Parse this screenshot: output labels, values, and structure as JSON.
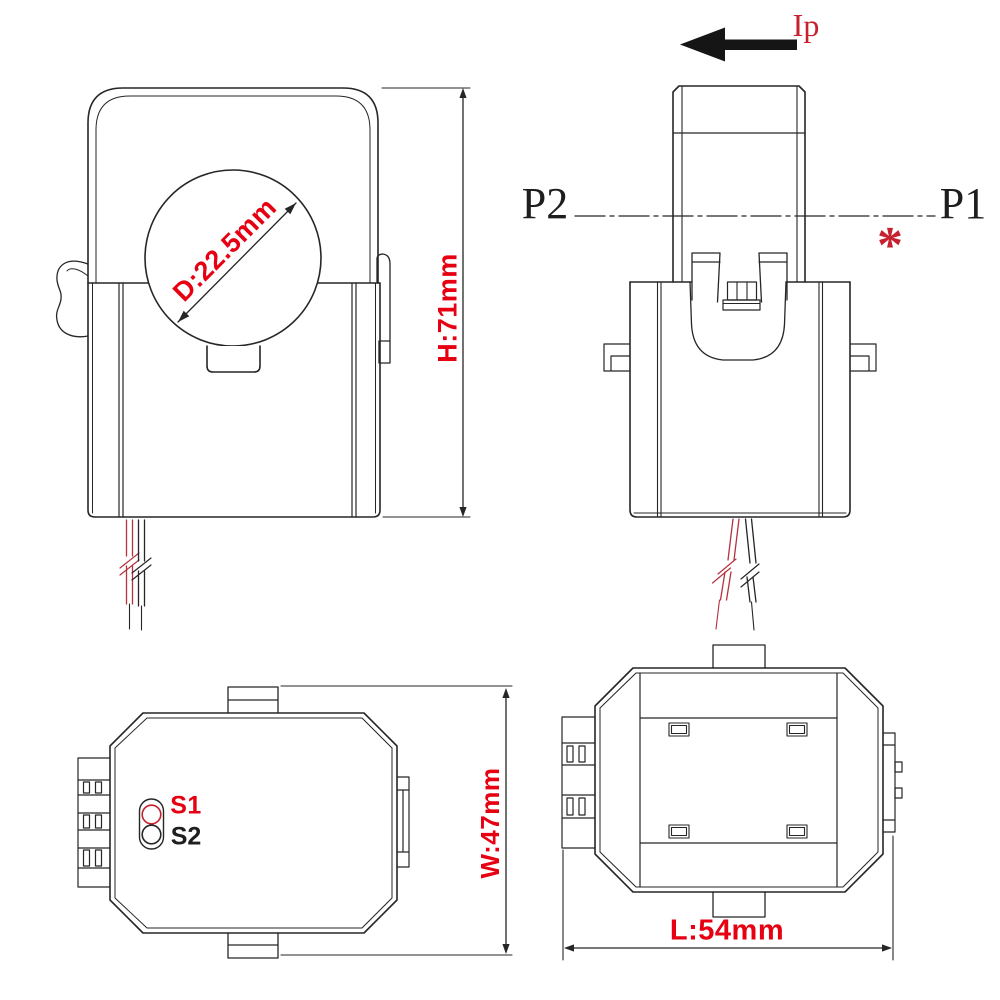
{
  "drawing": {
    "front_view": {
      "diameter_label": "D:22.5mm",
      "height_label": "H:71mm"
    },
    "side_view": {
      "primary_current_label": "Ip",
      "terminal_p2": "P2",
      "terminal_p1": "P1",
      "note_marker": "*"
    },
    "bottom_view": {
      "terminal_s1": "S1",
      "terminal_s2": "S2",
      "width_label": "W:47mm"
    },
    "top_view": {
      "length_label": "L:54mm"
    }
  },
  "colors": {
    "dimension_red": "#e60012",
    "annotation_red": "#c5212f",
    "line_color": "#262626",
    "wire_red": "#b5323f",
    "background": "#ffffff"
  },
  "icons": {
    "current_direction_arrow": "left-arrow"
  }
}
